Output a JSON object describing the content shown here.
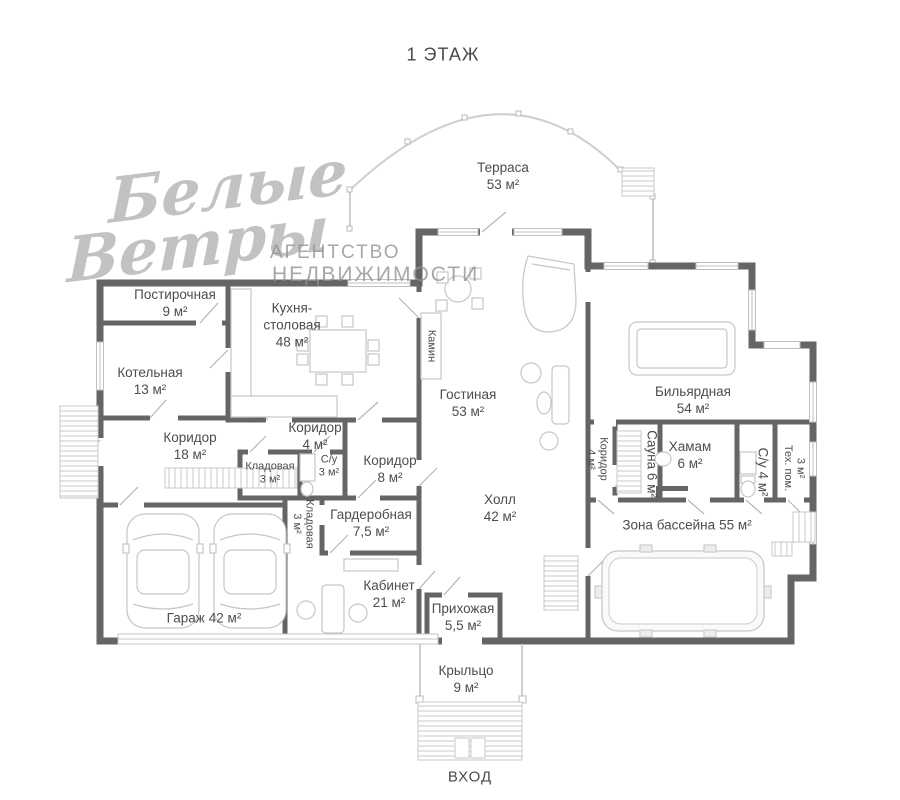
{
  "title": "1 ЭТАЖ",
  "entrance": "ВХОД",
  "watermark": {
    "script_top": "Белые",
    "script_bottom": "Ветры",
    "agency_line1": "АГЕНТСТВО",
    "agency_line2": "НЕДВИЖИМОСТИ"
  },
  "colors": {
    "wall": "#656565",
    "label": "#4d4d4d",
    "furniture": "#c6c6c6",
    "watermark": "#929292"
  },
  "rooms": {
    "terrace": {
      "name": "Терраса",
      "area": "53 м²"
    },
    "laundry": {
      "name": "Постирочная",
      "area": "9 м²"
    },
    "kitchen": {
      "name": "Кухня-столовая",
      "area": "48 м²"
    },
    "boiler": {
      "name": "Котельная",
      "area": "13 м²"
    },
    "corridor_18": {
      "name": "Коридор",
      "area": "18 м²"
    },
    "corridor_4_left": {
      "name": "Коридор",
      "area": "4 м²"
    },
    "pantry_3_upper": {
      "name": "Кладовая",
      "area": "3 м²"
    },
    "wc_3": {
      "name": "С/у",
      "area": "3 м²"
    },
    "corridor_8": {
      "name": "Коридор",
      "area": "8 м²"
    },
    "pantry_3_lower": {
      "name": "Кладовая",
      "area": "3 м²"
    },
    "wardrobe": {
      "name": "Гардеробная",
      "area": "7,5 м²"
    },
    "garage": {
      "name": "Гараж",
      "area": "42 м²"
    },
    "cabinet": {
      "name": "Кабинет",
      "area": "21 м²"
    },
    "hallway": {
      "name": "Прихожая",
      "area": "5,5 м²"
    },
    "living": {
      "name": "Гостиная",
      "area": "53 м²"
    },
    "fireplace": {
      "name": "Камин",
      "area": ""
    },
    "hall": {
      "name": "Холл",
      "area": "42 м²"
    },
    "billiard": {
      "name": "Бильярдная",
      "area": "54 м²"
    },
    "corridor_4_right": {
      "name": "Коридор",
      "area": "4 м²"
    },
    "sauna": {
      "name": "Сауна",
      "area": "6 м²"
    },
    "hamam": {
      "name": "Хамам",
      "area": "6 м²"
    },
    "wc_4": {
      "name": "С/у",
      "area": "4 м²"
    },
    "tech": {
      "name": "Тех. пом.",
      "area": "3 м²"
    },
    "pool_zone": {
      "name": "Зона бассейна",
      "area": "55 м²"
    },
    "porch": {
      "name": "Крыльцо",
      "area": "9 м²"
    }
  }
}
